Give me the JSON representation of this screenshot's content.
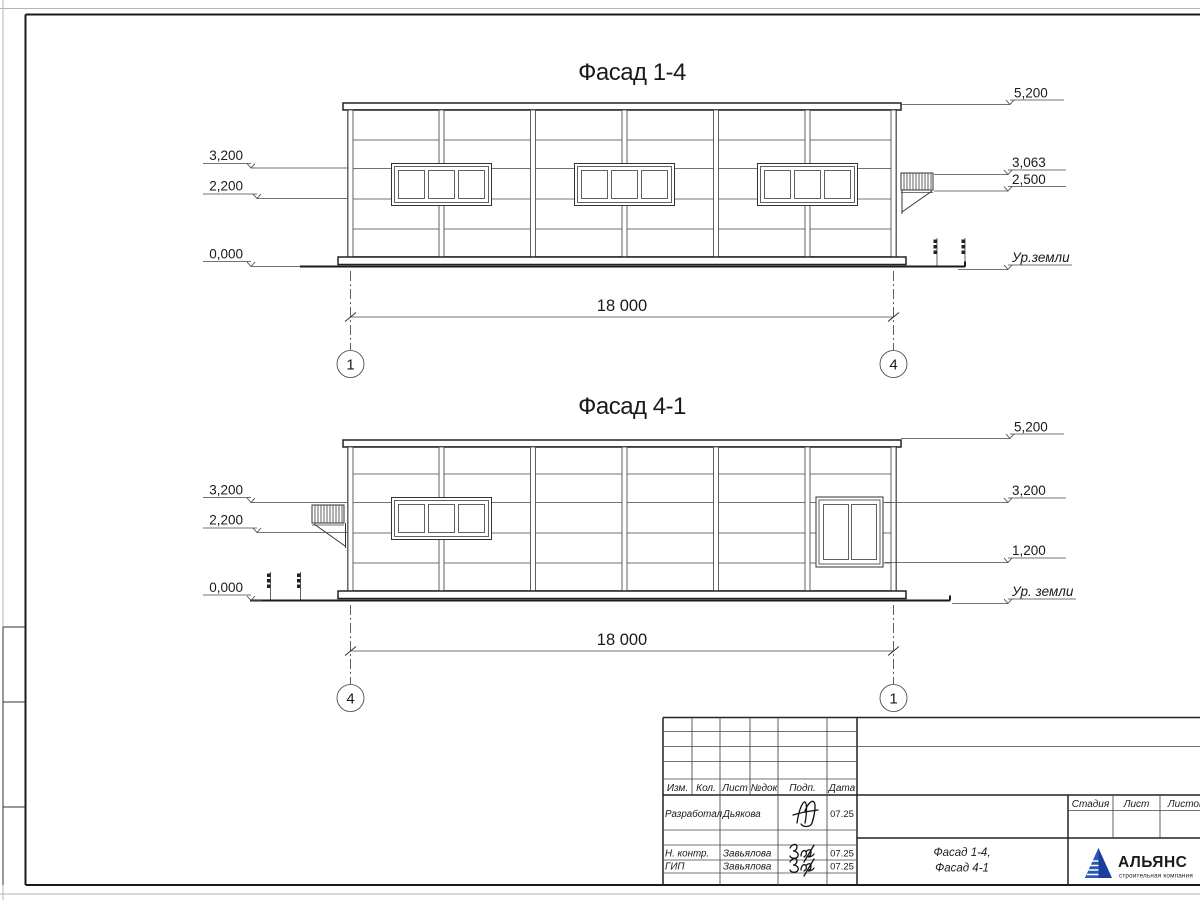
{
  "drawing": {
    "ink_color": "#1a1a1a",
    "facade_top": {
      "title": "Фасад 1-4",
      "axis_left": "1",
      "axis_right": "4",
      "span_dimension": "18 000",
      "marks_left": [
        "3,200",
        "2,200",
        "0,000"
      ],
      "marks_right": [
        "5,200",
        "3,063",
        "2,500"
      ],
      "ground_label": "Ур.земли"
    },
    "facade_bottom": {
      "title": "Фасад 4-1",
      "axis_left": "4",
      "axis_right": "1",
      "span_dimension": "18 000",
      "marks_left": [
        "3,200",
        "2,200",
        "0,000"
      ],
      "marks_right": [
        "5,200",
        "3,200",
        "1,200"
      ],
      "ground_label": "Ур. земли"
    }
  },
  "title_block": {
    "header_cols": [
      "Изм.",
      "Кол.",
      "Лист",
      "№док",
      "Подп.",
      "Дата"
    ],
    "rows": [
      {
        "role": "Разработал",
        "name": "Дьякова",
        "date": "07.25"
      },
      {
        "role": "Н. контр.",
        "name": "Завьялова",
        "date": "07.25"
      },
      {
        "role": "ГИП",
        "name": "Завьялова",
        "date": "07.25"
      }
    ],
    "doc_title_line1": "Фасад 1-4,",
    "doc_title_line2": "Фасад 4-1",
    "stage_label": "Стадия",
    "sheet_label": "Лист",
    "sheets_label": "Листов",
    "logo": {
      "name": "АЛЬЯНС",
      "subtitle": "строительная компания",
      "brand_color": "#22328c",
      "subtitle_color": "#3f9ad1"
    }
  }
}
